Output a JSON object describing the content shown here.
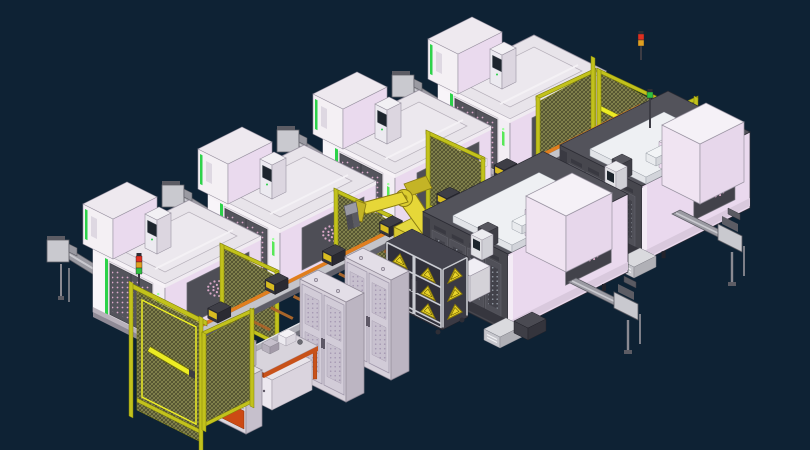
{
  "scene": {
    "canvas": {
      "width": 810,
      "height": 450
    },
    "background": "#0e2234",
    "palette": {
      "navy": "#0e2234",
      "vmcFace": "#f3eef4",
      "pinkFace": "#ead9ee",
      "pinkDeep": "#dfcbe4",
      "topFace": "#e8e4ea",
      "whiteBright": "#f8f5f9",
      "edge": "#9a94a2",
      "doorGray": "#54545c",
      "doorDark": "#3e3e46",
      "holePink": "#dba9c9",
      "green": "#2dd24a",
      "greenBright": "#58e858",
      "plinth": "#8f8a96",
      "plinthSide": "#6f6a76",
      "conveyorLight": "#c9c9cf",
      "conveyorMid": "#9a9aa2",
      "conveyorDark": "#5c5c64",
      "steel": "#8a8a92",
      "fenceYellow": "#c2c21c",
      "fenceBright": "#ecec24",
      "fenceDark": "#7e7e08",
      "meshBase": "#565632",
      "meshLine": "#b0b068",
      "railGray": "#c4c4ca",
      "railSide": "#5e5e68",
      "railOrange": "#e07e1e",
      "railNear": "#b0b0b8",
      "slatBrown": "#a8652a",
      "blockDark": "#34343c",
      "blockSide": "#2a2a32",
      "labelYellow": "#d8bc20",
      "robotYellow": "#e6d738",
      "robotShade": "#c4b426",
      "robotDark": "#8a7c12",
      "hmcBody": "#47474e",
      "hmcDoor": "#505058",
      "hmcDark": "#42424a",
      "hmcTop": "#53535b",
      "hmcSkirt": "#36363e",
      "grayDot": "#9298a2",
      "gantryWhite": "#e9ebee",
      "screenDark": "#1d252d",
      "screenGlare": "#7d8fa0",
      "cabFace": "#d7d1db",
      "cabSide": "#bcb5c2",
      "cabTop": "#e3dee7",
      "cabDoor": "#d2ccd8",
      "ventBase": "#c7c0ce",
      "ventDot": "#a598b2",
      "orange": "#c8521a",
      "orangeDark": "#a43f10",
      "benchTop": "#d8d4dc",
      "consoleOrange": "#cc4a14",
      "triYellow": "#e9d42a",
      "triEdge": "#8a7a08",
      "rackFrame": "#c9cbd1",
      "rackBack": "#30303a",
      "white": "#f2f0f4",
      "red": "#e03020",
      "amber": "#e0a020",
      "grnLight": "#30c040"
    },
    "vmc_machines": [
      {
        "id": "vmc-4",
        "x": 510,
        "y": 183
      },
      {
        "id": "vmc-3",
        "x": 395,
        "y": 238
      },
      {
        "id": "vmc-2",
        "x": 280,
        "y": 293
      },
      {
        "id": "vmc-1",
        "x": 165,
        "y": 348
      }
    ],
    "corner_fence": {
      "wing_left": {
        "x": 538,
        "y": 98,
        "len": 56,
        "h": 78,
        "dir": "A"
      },
      "post": {
        "x": 593,
        "y": 58,
        "h": 92
      },
      "wing_right": {
        "x": 599,
        "y": 70,
        "len": 69,
        "h": 78,
        "dir": "B"
      },
      "extension": {
        "x": 668,
        "y": 104,
        "len": 38,
        "h": 72,
        "dir": "B"
      }
    },
    "rear_fence": {
      "x": 636,
      "y": 128,
      "len": 60,
      "h": 75,
      "dir": "A"
    },
    "stub_fences": [
      {
        "x": 428,
        "y": 132,
        "len": 55,
        "h": 78,
        "dir": "B"
      },
      {
        "x": 336,
        "y": 190,
        "len": 55,
        "h": 75,
        "dir": "B"
      },
      {
        "x": 222,
        "y": 245,
        "len": 55,
        "h": 75,
        "dir": "B"
      }
    ],
    "rail": {
      "far": {
        "x1": 160,
        "y1": 356,
        "x2": 640,
        "y2": 116
      },
      "near": {
        "x1": 196,
        "y1": 382,
        "x2": 628,
        "y2": 166
      },
      "slats": {
        "count": 20,
        "t0": 0.03,
        "step": 0.0485
      },
      "stations": [
        0.1,
        0.225,
        0.35,
        0.475,
        0.6,
        0.725
      ]
    },
    "robot": {
      "pedestal_x": 436,
      "pedestal_y": 282,
      "turret_x": 424,
      "turret_y": 258
    },
    "hmc_machines": [
      {
        "id": "hmc-2",
        "x": 642,
        "y": 262,
        "a": 108,
        "b": 82,
        "h": 76,
        "cover": {
          "dx": 58,
          "dy": -58,
          "a": 44,
          "b": 38,
          "h": 60
        }
      },
      {
        "id": "hmc-1",
        "x": 508,
        "y": 332,
        "a": 120,
        "b": 85,
        "h": 78,
        "cover": {
          "dx": 58,
          "dy": -60,
          "a": 46,
          "b": 40,
          "h": 56
        }
      }
    ],
    "hmc_conveyors": [
      {
        "x": 716,
        "y": 222
      },
      {
        "x": 612,
        "y": 290
      }
    ],
    "rail_stand": {
      "x": 470,
      "y": 302
    },
    "pallet_rack": {
      "x": 442,
      "y": 330,
      "a": 26,
      "b": 56,
      "h": 60
    },
    "cabinets": [
      {
        "x": 391,
        "y": 380
      },
      {
        "x": 346,
        "y": 402
      }
    ],
    "workbench": {
      "x": 238,
      "y": 360
    },
    "console": {
      "x": 246,
      "y": 434
    },
    "gate": {
      "x": 131,
      "y": 283
    },
    "side_panel": {
      "x": 204,
      "y": 334,
      "len": 48,
      "h": 95,
      "dir": "A"
    },
    "stack_lights": [
      {
        "x": 139,
        "y": 256,
        "segments": [
          "#e03020",
          "#e0a020",
          "#30c040"
        ],
        "pole": 12
      },
      {
        "x": 641,
        "y": 34,
        "segments": [
          "#e03020",
          "#e0a020"
        ],
        "pole": 14
      },
      {
        "x": 650,
        "y": 92,
        "segments": [
          "#30c040"
        ],
        "pole": 30
      }
    ]
  }
}
